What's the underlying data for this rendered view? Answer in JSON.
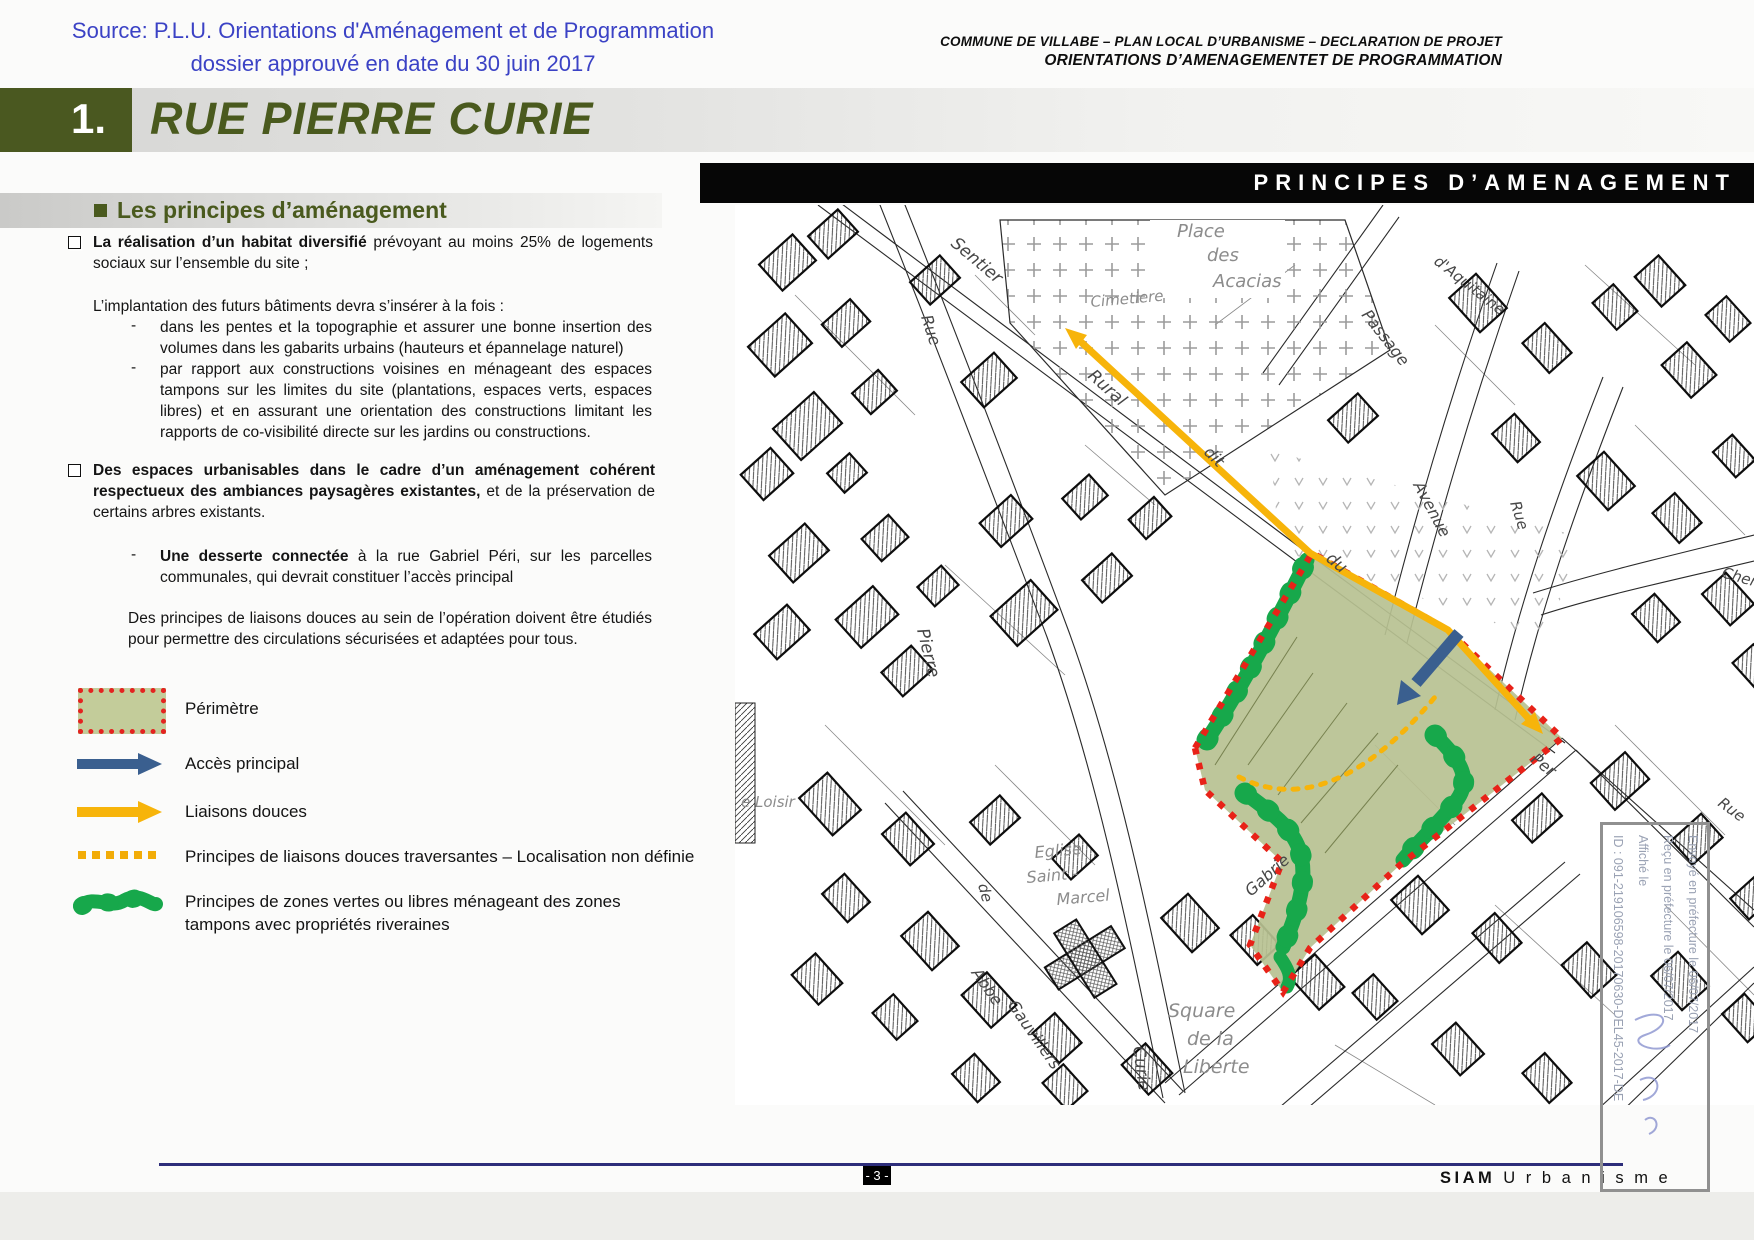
{
  "header": {
    "source_line1": "Source: P.L.U. Orientations d'Aménagement et de Programmation",
    "source_line2": "dossier approuvé en date du 30 juin 2017",
    "doc_line1": "COMMUNE DE VILLABE – PLAN LOCAL D’URBANISME – DECLARATION DE PROJET",
    "doc_line2": "ORIENTATIONS D’AMENAGEMENTET DE PROGRAMMATION"
  },
  "title": {
    "number": "1.",
    "name": "RUE PIERRE CURIE"
  },
  "section": {
    "heading": "Les principes d’aménagement"
  },
  "map_banner": "PRINCIPES D’AMENAGEMENT",
  "principles": {
    "dash": "-",
    "item1": {
      "bold": "La réalisation d’un habitat diversifié",
      "rest": " prévoyant au moins 25% de logements sociaux sur l’ensemble du site ;"
    },
    "intro": "L’implantation des futurs bâtiments devra s’insérer à la fois :",
    "sub1": "dans les pentes et la topographie et assurer une bonne insertion des volumes dans les gabarits urbains (hauteurs et épannelage naturel)",
    "sub2": "par rapport aux constructions voisines en ménageant des espaces tampons sur les limites du site (plantations, espaces verts, espaces libres) et en assurant une orientation des constructions limitant les rapports de co-visibilité directe sur les jardins ou constructions.",
    "item2": {
      "bold": "Des espaces urbanisables dans le cadre d’un aménagement cohérent respectueux des ambiances paysagères existantes,",
      "rest": " et de la préservation de certains arbres existants."
    },
    "sub3": {
      "bold": "Une desserte connectée",
      "rest": " à la rue Gabriel Péri, sur les parcelles communales, qui devrait constituer l’accès principal"
    },
    "closing": "Des principes de liaisons douces au sein de l’opération doivent être étudiés pour permettre des circulations sécurisées et adaptées pour tous."
  },
  "legend": {
    "items": [
      {
        "symbol": "perimeter-swatch",
        "label": "Périmètre"
      },
      {
        "symbol": "blue-arrow",
        "label": "Accès principal"
      },
      {
        "symbol": "yellow-arrow",
        "label": "Liaisons douces"
      },
      {
        "symbol": "yellow-dotted-line",
        "label": "Principes de liaisons douces traversantes – Localisation non définie"
      },
      {
        "symbol": "green-blob",
        "label": "Principes de zones vertes ou libres ménageant des zones tampons avec propriétés riveraines"
      }
    ]
  },
  "map": {
    "labels": [
      {
        "t": "Sentier",
        "x": 215,
        "y": 40,
        "r": 40,
        "s": 17,
        "c": "s"
      },
      {
        "t": "Rue",
        "x": 186,
        "y": 112,
        "r": 72,
        "s": 16,
        "c": "s"
      },
      {
        "t": "Cimetiere",
        "x": 356,
        "y": 102,
        "r": -5,
        "s": 15,
        "c": "p"
      },
      {
        "t": "Place",
        "x": 442,
        "y": 32,
        "r": 0,
        "s": 18,
        "c": "p"
      },
      {
        "t": "des",
        "x": 472,
        "y": 56,
        "r": 0,
        "s": 18,
        "c": "p"
      },
      {
        "t": "Acacias",
        "x": 478,
        "y": 82,
        "r": 0,
        "s": 18,
        "c": "p"
      },
      {
        "t": "Rural",
        "x": 352,
        "y": 172,
        "r": 42,
        "s": 17,
        "c": "s"
      },
      {
        "t": "dit",
        "x": 468,
        "y": 248,
        "r": 45,
        "s": 16,
        "c": "s"
      },
      {
        "t": "du",
        "x": 590,
        "y": 355,
        "r": 40,
        "s": 17,
        "c": "s"
      },
      {
        "t": "Passage",
        "x": 626,
        "y": 110,
        "r": 52,
        "s": 16,
        "c": "s"
      },
      {
        "t": "d'Aquitaine",
        "x": 698,
        "y": 58,
        "r": 38,
        "s": 15,
        "c": "s"
      },
      {
        "t": "Avenue",
        "x": 678,
        "y": 280,
        "r": 62,
        "s": 16,
        "c": "s"
      },
      {
        "t": "Rue",
        "x": 775,
        "y": 298,
        "r": 72,
        "s": 15,
        "c": "s"
      },
      {
        "t": "Chem",
        "x": 986,
        "y": 372,
        "r": 16,
        "s": 15,
        "c": "s"
      },
      {
        "t": "Pierre",
        "x": 182,
        "y": 425,
        "r": 76,
        "s": 17,
        "c": "s"
      },
      {
        "t": "e Loisir",
        "x": 6,
        "y": 602,
        "r": 0,
        "s": 15,
        "c": "p"
      },
      {
        "t": "de",
        "x": 243,
        "y": 680,
        "r": 75,
        "s": 15,
        "c": "s"
      },
      {
        "t": "Abbe",
        "x": 236,
        "y": 768,
        "r": 55,
        "s": 16,
        "c": "s"
      },
      {
        "t": "Gauvillers",
        "x": 272,
        "y": 800,
        "r": 55,
        "s": 16,
        "c": "s"
      },
      {
        "t": "Eglise",
        "x": 300,
        "y": 653,
        "r": -5,
        "s": 16,
        "c": "p"
      },
      {
        "t": "Saint  -",
        "x": 292,
        "y": 678,
        "r": -5,
        "s": 16,
        "c": "p"
      },
      {
        "t": "Marcel",
        "x": 322,
        "y": 700,
        "r": -5,
        "s": 16,
        "c": "p"
      },
      {
        "t": "Curie",
        "x": 398,
        "y": 842,
        "r": 82,
        "s": 17,
        "c": "s"
      },
      {
        "t": "Square",
        "x": 433,
        "y": 812,
        "r": 0,
        "s": 19,
        "c": "p"
      },
      {
        "t": "de  la",
        "x": 452,
        "y": 840,
        "r": 0,
        "s": 19,
        "c": "p"
      },
      {
        "t": "Liberte",
        "x": 448,
        "y": 868,
        "r": 0,
        "s": 19,
        "c": "p"
      },
      {
        "t": "Gabrie",
        "x": 516,
        "y": 692,
        "r": -42,
        "s": 16,
        "c": "s"
      },
      {
        "t": "Per",
        "x": 795,
        "y": 556,
        "r": 38,
        "s": 16,
        "c": "s"
      },
      {
        "t": "Rue",
        "x": 982,
        "y": 600,
        "r": 36,
        "s": 15,
        "c": "s"
      }
    ],
    "stamp": {
      "lines": [
        "Envoyé en préfecture le 06/07/2017",
        "Reçu en préfecture le 06/07/2017",
        "Affiché le",
        "ID : 091-219106598-20170630-DEL45-2017-DE"
      ]
    }
  },
  "footer": {
    "page_number": "- 3 -",
    "brand_bold": "SIAM",
    "brand_rest": "U r b a n i s m e"
  },
  "colors": {
    "olive_title": "#4a5a1e",
    "header_blue": "#3b42c5",
    "banner_bg": "#060606",
    "perimeter_red": "#e42320",
    "site_green": "#b7c191",
    "access_blue": "#3a5f8f",
    "liaison_yellow": "#f7b40a",
    "zone_green": "#17a84b",
    "footer_navy": "#2d2d7a"
  }
}
